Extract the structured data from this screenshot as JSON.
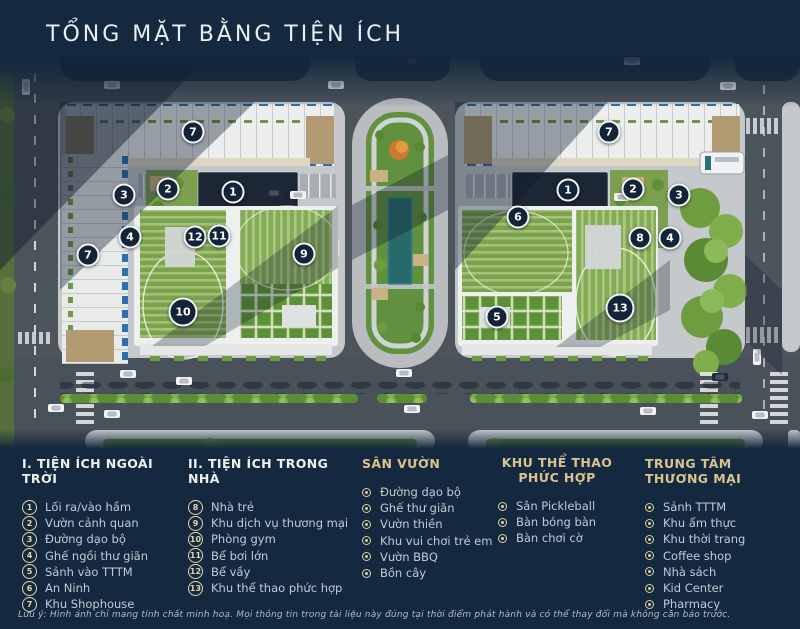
{
  "title": "TỔNG MẶT BẰNG TIỆN ÍCH",
  "colors": {
    "background": "#142840",
    "accent_gold": "#d9c48e",
    "marker_bg": "#142438",
    "marker_border": "#f3f5f7",
    "lawn_green": "#7ca34c",
    "pool_teal": "#266a6b",
    "road_gray": "#4c545c",
    "sidewalk_gray": "#c6c9cb"
  },
  "map": {
    "markers": [
      {
        "n": "7",
        "x": 193,
        "y": 132
      },
      {
        "n": "3",
        "x": 124,
        "y": 195
      },
      {
        "n": "2",
        "x": 168,
        "y": 189
      },
      {
        "n": "1",
        "x": 233,
        "y": 192
      },
      {
        "n": "4",
        "x": 130,
        "y": 237
      },
      {
        "n": "12",
        "x": 195,
        "y": 237
      },
      {
        "n": "11",
        "x": 219,
        "y": 236
      },
      {
        "n": "9",
        "x": 304,
        "y": 254
      },
      {
        "n": "7",
        "x": 88,
        "y": 255
      },
      {
        "n": "10",
        "x": 183,
        "y": 312,
        "size": 29
      },
      {
        "n": "7",
        "x": 609,
        "y": 132
      },
      {
        "n": "1",
        "x": 568,
        "y": 190
      },
      {
        "n": "2",
        "x": 633,
        "y": 189
      },
      {
        "n": "3",
        "x": 679,
        "y": 195
      },
      {
        "n": "6",
        "x": 518,
        "y": 217
      },
      {
        "n": "8",
        "x": 640,
        "y": 238
      },
      {
        "n": "4",
        "x": 670,
        "y": 238
      },
      {
        "n": "13",
        "x": 620,
        "y": 308,
        "size": 29
      },
      {
        "n": "5",
        "x": 497,
        "y": 317
      }
    ]
  },
  "legend": {
    "columns": [
      {
        "title": "I. TIỆN ÍCH NGOÀI TRỜI",
        "heading_style": "white",
        "type": "numbered",
        "items": [
          {
            "n": "1",
            "label": "Lối ra/vào hầm"
          },
          {
            "n": "2",
            "label": "Vườn cảnh quan"
          },
          {
            "n": "3",
            "label": "Đường dạo bộ"
          },
          {
            "n": "4",
            "label": "Ghế ngồi thư giãn"
          },
          {
            "n": "5",
            "label": "Sảnh vào TTTM"
          },
          {
            "n": "6",
            "label": "An Ninh"
          },
          {
            "n": "7",
            "label": "Khu Shophouse"
          }
        ]
      },
      {
        "title": "II. TIỆN ÍCH TRONG NHÀ",
        "heading_style": "white",
        "type": "numbered",
        "items": [
          {
            "n": "8",
            "label": "Nhà trẻ"
          },
          {
            "n": "9",
            "label": "Khu dịch vụ thương mại"
          },
          {
            "n": "10",
            "label": "Phòng gym"
          },
          {
            "n": "11",
            "label": "Bể bơi lớn"
          },
          {
            "n": "12",
            "label": "Bể vầy"
          },
          {
            "n": "13",
            "label": "Khu thể thao phức hợp"
          }
        ]
      },
      {
        "title": "SÂN VƯỜN",
        "heading_style": "gold",
        "type": "bullet",
        "items": [
          {
            "label": "Đường dạo bộ"
          },
          {
            "label": "Ghế thư giãn"
          },
          {
            "label": "Vườn thiền"
          },
          {
            "label": "Khu vui chơi trẻ em"
          },
          {
            "label": "Vườn BBQ"
          },
          {
            "label": "Bồn cây"
          }
        ]
      },
      {
        "title": "KHU THỂ THAO PHỨC HỢP",
        "heading_style": "gold",
        "type": "bullet",
        "items": [
          {
            "label": "Sân Pickleball"
          },
          {
            "label": "Bàn bóng bàn"
          },
          {
            "label": "Bàn chơi cờ"
          }
        ]
      },
      {
        "title": "TRUNG TÂM THƯƠNG MẠI",
        "heading_style": "gold",
        "type": "bullet",
        "items": [
          {
            "label": "Sảnh TTTM"
          },
          {
            "label": "Khu ẩm thực"
          },
          {
            "label": "Khu thời trang"
          },
          {
            "label": "Coffee shop"
          },
          {
            "label": "Nhà sách"
          },
          {
            "label": "Kid Center"
          },
          {
            "label": "Pharmacy"
          }
        ]
      }
    ]
  },
  "footnote": "Lưu ý: Hình ảnh chỉ mang tính chất minh hoạ. Mọi thông tin trong tài liệu này đúng tại thời điểm phát hành và có thể thay đổi mà không cần báo trước."
}
